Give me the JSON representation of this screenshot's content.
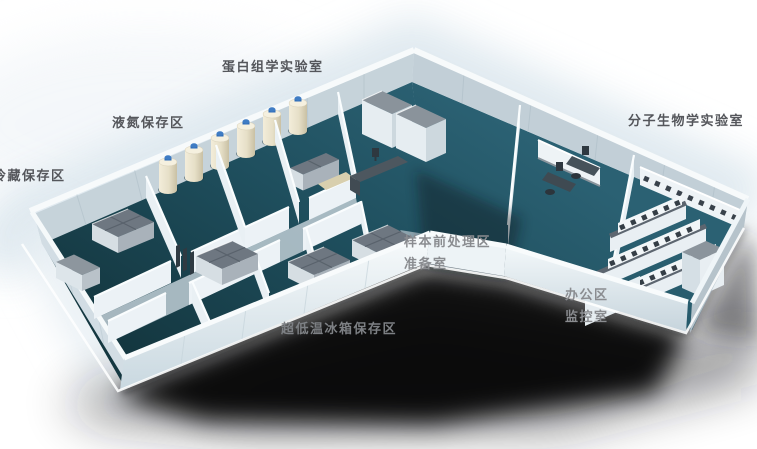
{
  "figure": {
    "description_labels_only": true,
    "colors": {
      "background": "#FFFFFF",
      "floor_teal": "#1F4E5A",
      "wall_light": "#F2F7F9",
      "wall_shade": "#C4D1D9",
      "corridor_gray": "#B6C5CD",
      "tank_body": "#E9E2CC",
      "tank_cap": "#2F6DB8",
      "freezer_top_gray": "#6E7781",
      "bench_top_gray": "#5D6670",
      "shadow": "#000000",
      "label_dark": "#54565B",
      "label_light": "#8A8C90"
    },
    "areas": {
      "proteomics_lab": {
        "label": "蛋白组学实验室"
      },
      "liquid_nitrogen_storage": {
        "label": "液氮保存区"
      },
      "cold_storage": {
        "label": "冷藏保存区"
      },
      "molecular_biology_lab": {
        "label": "分子生物学实验室"
      },
      "sample_pretreatment": {
        "label": "样本前处理区"
      },
      "prep_room": {
        "label": "准备室"
      },
      "office_area": {
        "label": "办公区"
      },
      "monitoring_room": {
        "label": "监控室"
      },
      "ult_freezer_storage": {
        "label": "超低温冰箱保存区"
      }
    }
  }
}
